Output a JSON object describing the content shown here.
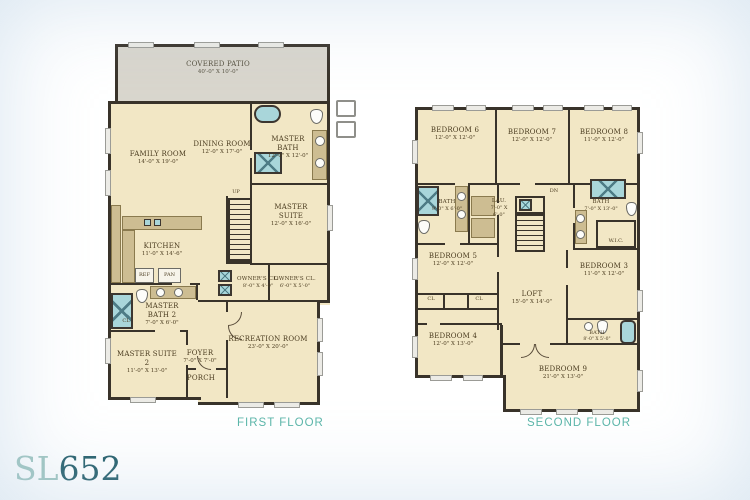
{
  "brand": {
    "prefix": "SL",
    "number": "652"
  },
  "captions": {
    "first": "FIRST FLOOR",
    "second": "SECOND FLOOR"
  },
  "colors": {
    "floor": "#f2e7c5",
    "wall": "#39332a",
    "patio": "#d9d6cd",
    "fixture_teal": "#a9d6da",
    "caption_teal": "#5cb6a9",
    "brand_light": "#a0c6c0",
    "brand_dark": "#27606c",
    "label_text": "#4a3b1f"
  },
  "first_floor": {
    "rooms": {
      "covered_patio": {
        "name": "COVERED PATIO",
        "dims": "40'-0\" X 10'-0\""
      },
      "family_room": {
        "name": "FAMILY ROOM",
        "dims": "14'-0\" X 19'-0\""
      },
      "dining_room": {
        "name": "DINING ROOM",
        "dims": "12'-0\" X 17'-0\""
      },
      "master_bath": {
        "name": "MASTER BATH",
        "dims": "12'-0\" X 12'-0\""
      },
      "master_suite": {
        "name": "MASTER SUITE",
        "dims": "12'-0\" X 16'-0\""
      },
      "kitchen": {
        "name": "KITCHEN",
        "dims": "11'-0\" X 14'-6\""
      },
      "master_bath_2": {
        "name": "MASTER BATH 2",
        "dims": "7'-0\" X 6'-0\""
      },
      "master_suite_2": {
        "name": "MASTER SUITE 2",
        "dims": "11'-0\" X 13'-0\""
      },
      "foyer": {
        "name": "FOYER",
        "dims": "7'-0\" X 7'-0\""
      },
      "porch": {
        "name": "PORCH",
        "dims": ""
      },
      "owners_closet": {
        "name": "OWNER'S CL.",
        "dims": "8'-0\" X 4'-0\""
      },
      "owners_closet_2": {
        "name": "OWNER'S CL.",
        "dims": "6'-0\" X 5'-0\""
      },
      "recreation_room": {
        "name": "RECREATION ROOM",
        "dims": "23'-0\" X 20'-0\""
      }
    },
    "small_labels": {
      "up": "UP",
      "ref": "REF",
      "pan": "PAN",
      "cl": "CL"
    }
  },
  "second_floor": {
    "rooms": {
      "bedroom_6": {
        "name": "BEDROOM 6",
        "dims": "12'-0\" X 12'-0\""
      },
      "bedroom_7": {
        "name": "BEDROOM 7",
        "dims": "12'-0\" X 12'-0\""
      },
      "bedroom_8": {
        "name": "BEDROOM 8",
        "dims": "11'-0\" X 12'-0\""
      },
      "bath_left": {
        "name": "BATH",
        "dims": "9'-0\" X 6'-0\""
      },
      "laundry": {
        "name": "LAU.",
        "dims": "7'-0\" X 6'-0\""
      },
      "bath_right": {
        "name": "BATH",
        "dims": "7'-0\" X 13'-0\""
      },
      "wic": {
        "name": "W.I.C.",
        "dims": ""
      },
      "bedroom_5": {
        "name": "BEDROOM 5",
        "dims": "12'-0\" X 12'-0\""
      },
      "loft": {
        "name": "LOFT",
        "dims": "15'-0\" X 14'-0\""
      },
      "bedroom_3": {
        "name": "BEDROOM 3",
        "dims": "11'-0\" X 12'-0\""
      },
      "bedroom_4": {
        "name": "BEDROOM 4",
        "dims": "12'-0\" X 13'-0\""
      },
      "bath_small": {
        "name": "BATH",
        "dims": "8'-0\" X 5'-0\""
      },
      "bedroom_9": {
        "name": "BEDROOM 9",
        "dims": "21'-0\" X 13'-0\""
      }
    },
    "small_labels": {
      "dn": "DN",
      "cl": "CL"
    }
  }
}
